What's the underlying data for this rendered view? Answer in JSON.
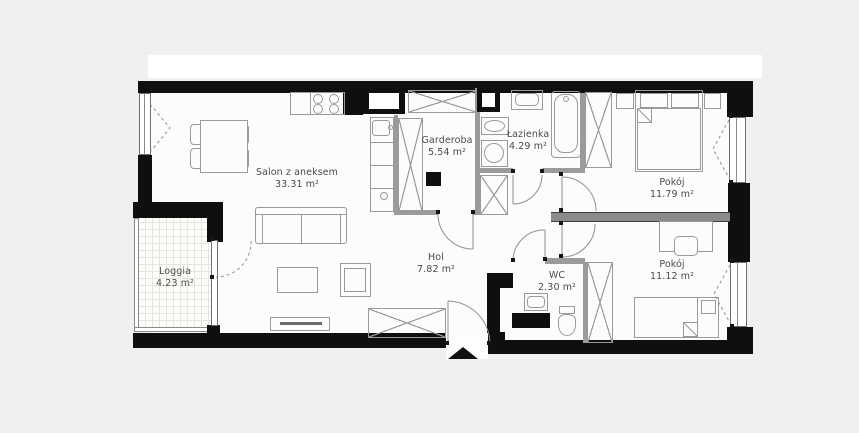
{
  "title": "Apartment floor plan",
  "rooms": {
    "salon": {
      "name": "Salon z aneksem",
      "area": "33.31 m²"
    },
    "garderoba": {
      "name": "Garderoba",
      "area": "5.54 m²"
    },
    "lazienka": {
      "name": "Łazienka",
      "area": "4.29 m²"
    },
    "pokoj1": {
      "name": "Pokój",
      "area": "11.79 m²"
    },
    "hol": {
      "name": "Hol",
      "area": "7.82 m²"
    },
    "wc": {
      "name": "WC",
      "area": "2.30 m²"
    },
    "pokoj2": {
      "name": "Pokój",
      "area": "11.12 m²"
    },
    "loggia": {
      "name": "Loggia",
      "area": "4.23 m²"
    }
  },
  "colors": {
    "wall": "#0f0f0f",
    "thin_wall": "#9b9b9b",
    "furniture_outline": "#9a9a9a",
    "floor": "#fcfcfa",
    "background": "#f1f0ee",
    "top_band": "#ffffff",
    "label_text": "#4b4b4b"
  },
  "icons": {
    "entrance_marker": "black triangle pointing up at main door"
  }
}
